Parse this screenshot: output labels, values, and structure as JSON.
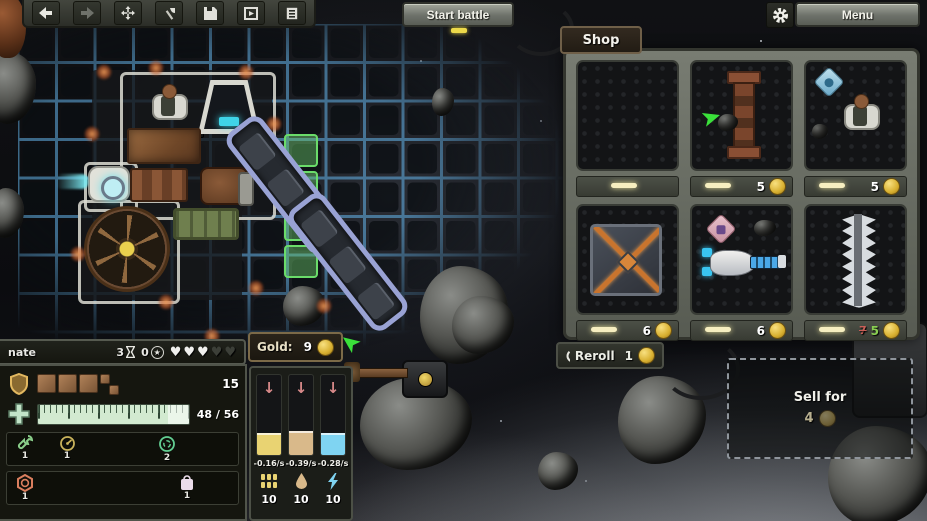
{
  "top_bar": {
    "start_battle_label": "Start battle",
    "menu_label": "Menu",
    "toolbar_icons": [
      "undo",
      "redo",
      "move",
      "build-axe",
      "save",
      "load-ship",
      "blueprint"
    ]
  },
  "shop": {
    "title": "Shop",
    "reroll_label": "Reroll",
    "reroll_cost": "1",
    "sell_label": "Sell for",
    "sell_value": "4",
    "items": [
      {
        "name": "empty-slot",
        "price": ""
      },
      {
        "name": "rusty-strut",
        "price": "5"
      },
      {
        "name": "crew-member",
        "price": "5"
      },
      {
        "name": "armored-plate-x",
        "price": "6"
      },
      {
        "name": "laser-cannon",
        "price": "6"
      },
      {
        "name": "spike-blade",
        "price": "5",
        "old_price": "7"
      }
    ]
  },
  "hud": {
    "player_name": "nate",
    "round_count": "3",
    "star_count": "0",
    "hearts": {
      "filled": 3,
      "empty": 2
    },
    "gold_label": "Gold:",
    "gold_value": "9",
    "armor_value": "15",
    "hull_value": "48 / 56",
    "inventory_row1": [
      {
        "icon": "wrench",
        "count": "1"
      },
      {
        "icon": "gauge",
        "count": "1"
      },
      {
        "icon": "shield-ring",
        "count": "2"
      }
    ],
    "inventory_row2": [
      {
        "icon": "reactor-hex",
        "count": "1"
      },
      {
        "icon": "loot-bag",
        "count": "1"
      }
    ],
    "resources": [
      {
        "name": "ammo",
        "rate": "-0.16/s",
        "amount": "10",
        "color": "#e9d372"
      },
      {
        "name": "fuel",
        "rate": "-0.39/s",
        "amount": "10",
        "color": "#d9b98a"
      },
      {
        "name": "energy",
        "rate": "-0.28/s",
        "amount": "10",
        "color": "#7fd4f2"
      }
    ]
  },
  "icons": {
    "heart": "♥",
    "star": "★",
    "down_arrow": "↓"
  }
}
